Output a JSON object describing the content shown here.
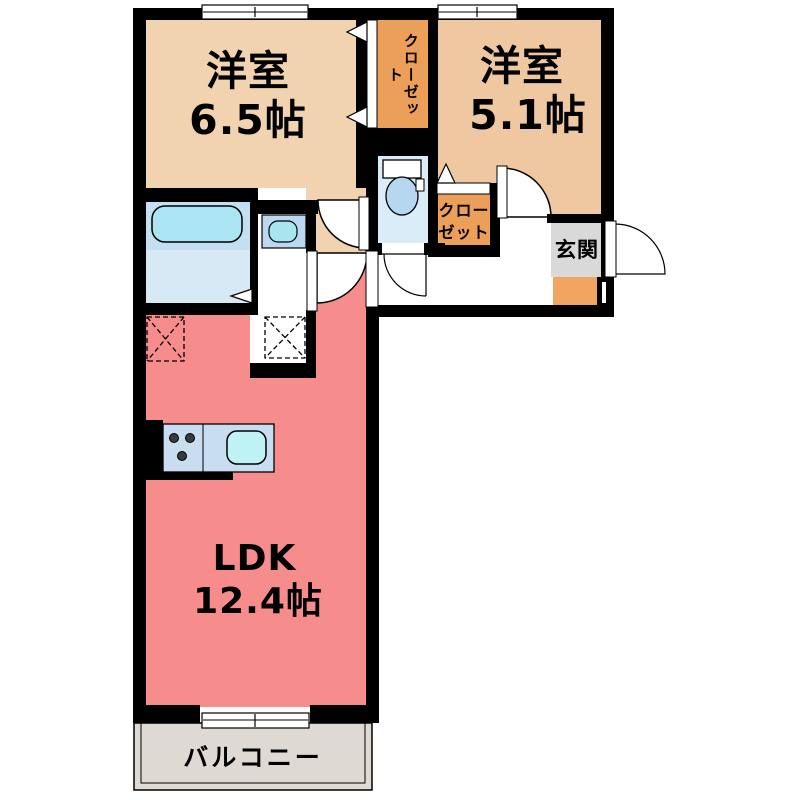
{
  "floorplan": {
    "kind": "apartment-floor-plan",
    "rooms": {
      "western_room_1": {
        "name": "洋室",
        "area": "6.5帖"
      },
      "western_room_2": {
        "name": "洋室",
        "area": "5.1帖"
      },
      "ldk": {
        "name": "LDK",
        "area": "12.4帖"
      },
      "closet_top": {
        "name": "クローゼット"
      },
      "closet_mid": {
        "name": "クローゼット"
      },
      "entrance": {
        "name": "玄関"
      },
      "balcony": {
        "name": "バルコニー"
      }
    },
    "colors": {
      "wall": "#000000",
      "western_room_1": "#F2D3AF",
      "western_room_2": "#EFC8A1",
      "closet": "#EC9F58",
      "ldk": "#F68C8C",
      "entrance_floor": "#D9D9D9",
      "shoe_cabinet": "#F2A55F",
      "balcony": "#DEDAD3",
      "bath_upper": "#C3DFF1",
      "bath_lower": "#D8E9F6",
      "bathtub": "#ABE4F3",
      "toilet_room": "#DAECF8",
      "toilet_bowl": "#B5D7F0",
      "washbasin_counter": "#BCD8F1",
      "washbasin": "#A5E6EF",
      "kitchen_counter": "#C9DDF0",
      "kitchen_sink": "#BFF2F4"
    }
  }
}
